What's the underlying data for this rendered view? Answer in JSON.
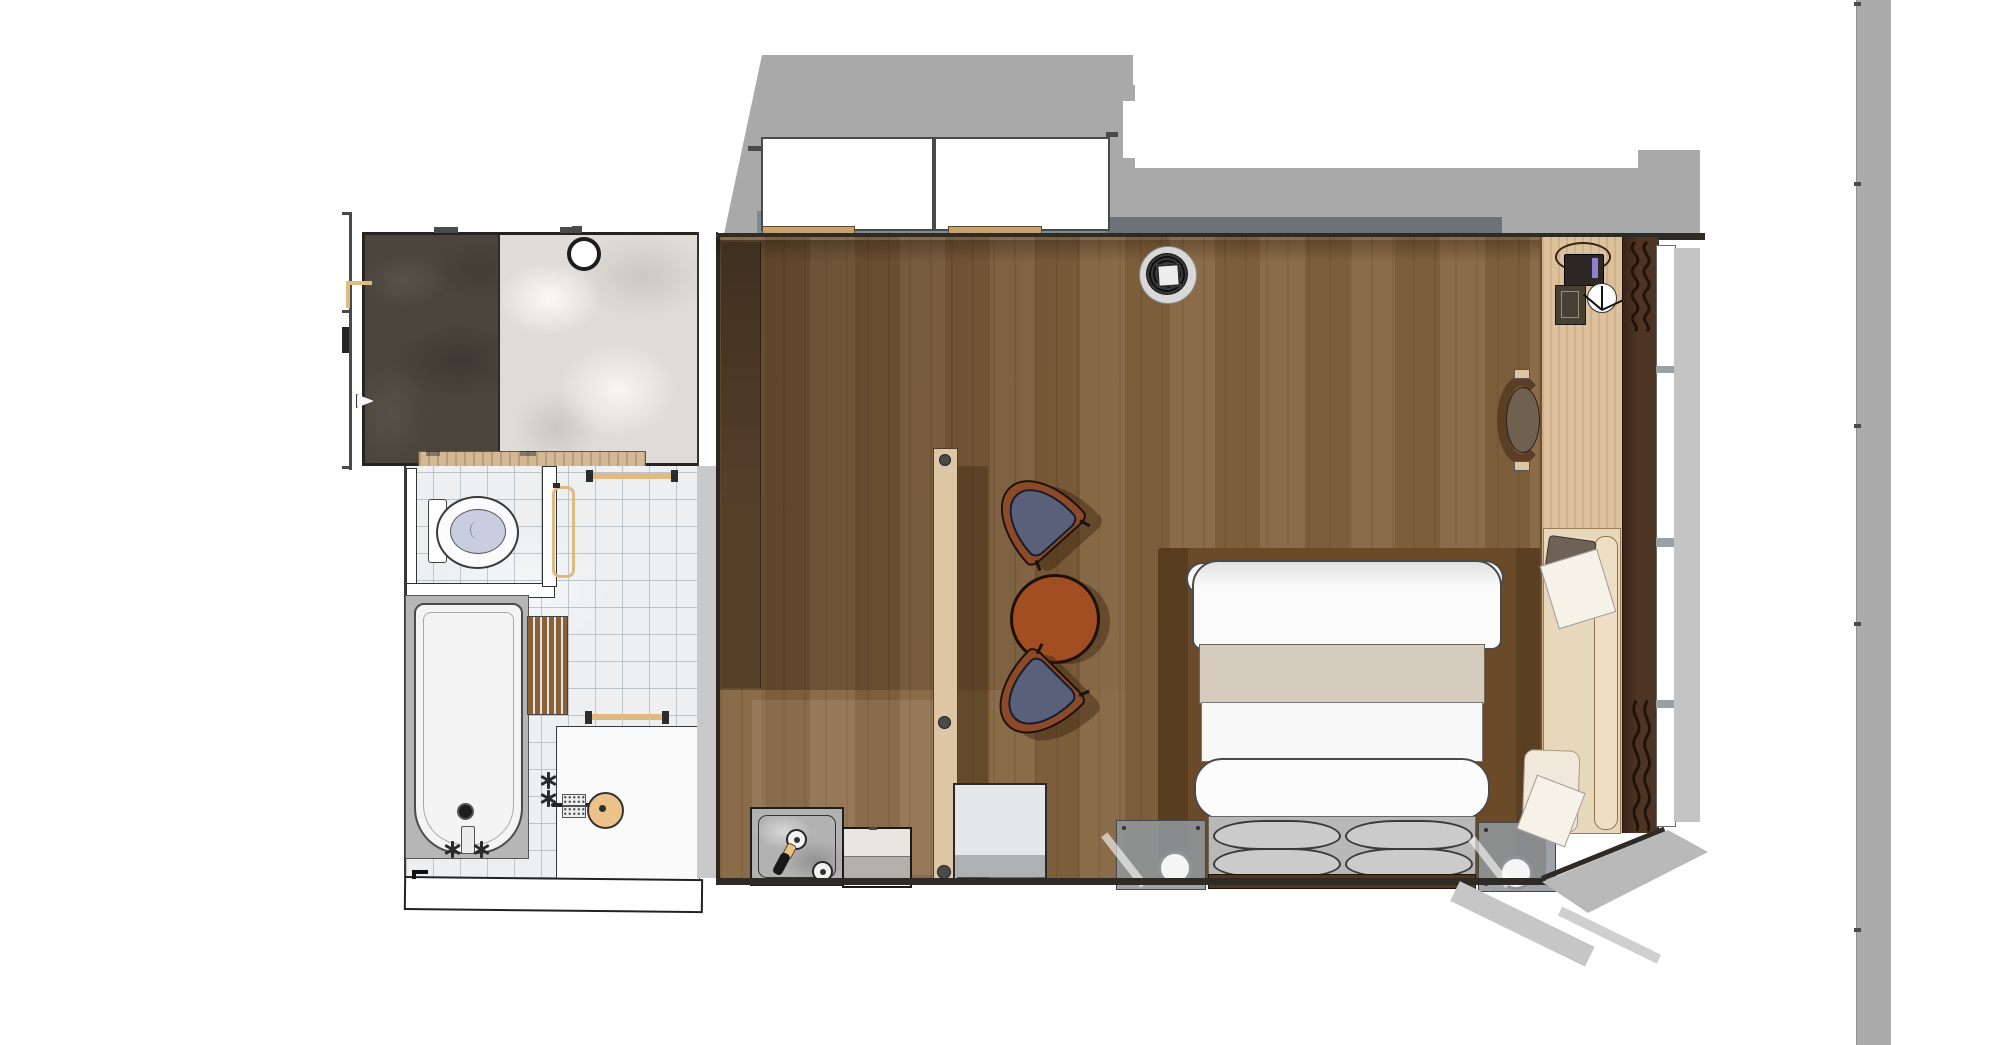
{
  "scene": {
    "kind": "floor-plan-top-down-render",
    "description": "SketchUp-style top-down rendering of a hotel guest room: en-suite bathroom (walk-in shower with dark marble floor, toilet cubicle, bathtub, wash basin) on the left and a bedroom (double bed on wood platform, two lounge chairs with round table, wood partition screen, minibar, desk with telephone, daybed, curtain and window wall) on the right.",
    "visible_text": []
  },
  "palette": {
    "shadow_gray": "#a9a9a9",
    "shadow_soft": "#c4c4c4",
    "sill_slate": "#7f8b93",
    "sill_dark": "#6e7277",
    "threshold_wood": "#c8a36f",
    "wall_dark": "#2e2a26",
    "marble_dark": "#4c453d",
    "marble_light": "#dfdbd7",
    "tile": "#edeff1",
    "tile_line": "rgba(150,160,170,0.55)",
    "vanity_wood": "#d3b896",
    "basket_tan": "#eac185",
    "porcelain": "#fbfbfb",
    "toilet_seat": "#c9cde0",
    "brass": "#dfba83",
    "tub_surround": "#b6b6b6",
    "tub_white": "#f4f4f4",
    "mat_wood": "#8a6036",
    "basin_tan": "#eac28a",
    "wall_gray_band": "#c9c9c9",
    "floor_wood": "#85643f",
    "wardrobe_wood": "#55402a",
    "partition_wood": "#dcc6a4",
    "table_sienna": "#a24e22",
    "chair_trim": "#8c4a28",
    "chair_seat": "#59617a",
    "furn_shadow": "rgba(56,32,10,0.42)",
    "platform_wood": "#6b4a28",
    "bed_white": "#fbfbfb",
    "bed_runner": "#d6ccbe",
    "pillow_area": "#b8b8b8",
    "pillow_gray": "#cbcbcb",
    "headboard_wood": "#50361a",
    "glass_gray": "rgba(145,150,155,0.88)",
    "lamp_white": "#f5f5f5",
    "desk_wood": "#dcc19c",
    "daybed_base": "#e7d7bb",
    "bolster": "#eedfc4",
    "cushion_dark": "#6e6256",
    "paper_white": "#f6f2e8",
    "deskchair_back": "#5a3f26",
    "deskchair_seat": "#70604f",
    "phone_dark": "#2d2825",
    "phone_screen": "#8f7fd0",
    "pad_dark": "#474034",
    "curtain_wood": "#4e3422",
    "squiggle": "#1f1309",
    "minibar_gray": "#b2b2b2",
    "fridge_top": "#e9e6e0",
    "fridge_bottom": "#b3b0ab",
    "sidetable_top": "#e5e7e9",
    "sidetable_band": "#aeb0b2",
    "bar_gray": "#ababab",
    "speaker_ring": "#d8d8d8"
  },
  "bathroom": {
    "fixtures": [
      "walk-in shower, dark marble floor",
      "light marble floor",
      "floor drain",
      "entry door",
      "vanity counter",
      "towel basket",
      "amenity dispenser",
      "toilet",
      "toilet cubicle",
      "vertical towel ring",
      "upper towel bar",
      "bathtub",
      "bath spout and cross handles",
      "teak bath mat",
      "wash counter",
      "round wash basin",
      "soap trays",
      "lower towel bar"
    ]
  },
  "bedroom": {
    "furniture": [
      "ceiling speaker / downlight",
      "wardrobe column",
      "wood partition screen",
      "lounge chair (upper)",
      "round side table",
      "lounge chair (lower)",
      "minibar tray with kettle, bottle and cup",
      "mini fridge cabinet",
      "white side table",
      "bed platform",
      "double bed with duvet, runner and rolled blanket",
      "four pillows",
      "headboard",
      "left nightstand with lamp",
      "right nightstand with lamp",
      "desk with telephone, wall pad and clock",
      "desk chair",
      "daybed with bolster, cushions and papers",
      "curtain",
      "window wall"
    ]
  },
  "architecture": {
    "elements": [
      "two white closet volumes at top",
      "blue-gray window sill strip",
      "roof shadow polygons",
      "bathroom/bedroom dividing wall",
      "bottom exterior wall",
      "slanted south-east wall",
      "free-standing gray pillar strip at far right"
    ]
  }
}
